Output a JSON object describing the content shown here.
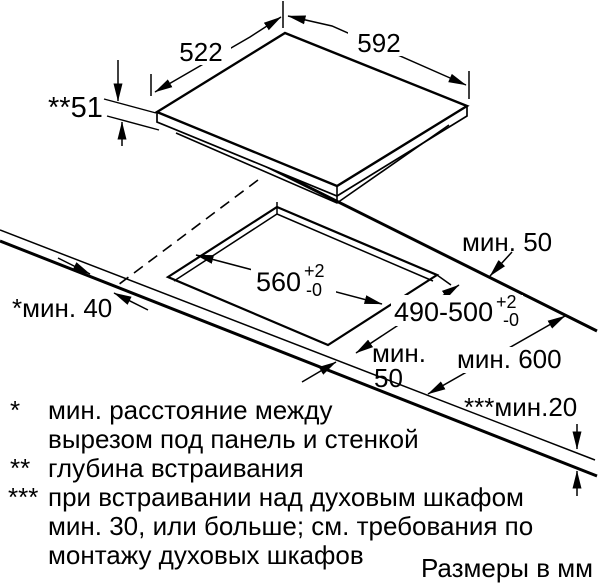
{
  "diagram": {
    "units_note": "Размеры в мм",
    "appliance": {
      "width": "592",
      "depth": "522",
      "installation_depth": "**51"
    },
    "cutout": {
      "width": "560",
      "width_tol_plus": "+2",
      "width_tol_minus": "-0",
      "depth": "490-500",
      "depth_tol_plus": "+2",
      "depth_tol_minus": "-0"
    },
    "clearances": {
      "rear_min": "мин. 50",
      "front_min_line1": "мин.",
      "front_min_line2": "50",
      "side_min": "*мин. 40",
      "worktop_depth_min": "мин. 600",
      "worktop_thickness_min": "***мин.20"
    },
    "footnotes": [
      {
        "symbol": "*",
        "lines": [
          "мин. расстояние между",
          "вырезом под панель и стенкой"
        ]
      },
      {
        "symbol": "**",
        "lines": [
          "глубина встраивания"
        ]
      },
      {
        "symbol": "***",
        "lines": [
          "при встраивании над духовым шкафом",
          "мин. 30, или больше; см. требования по",
          "монтажу духовых шкафов"
        ]
      }
    ],
    "colors": {
      "line": "#000000",
      "background": "#ffffff"
    }
  }
}
